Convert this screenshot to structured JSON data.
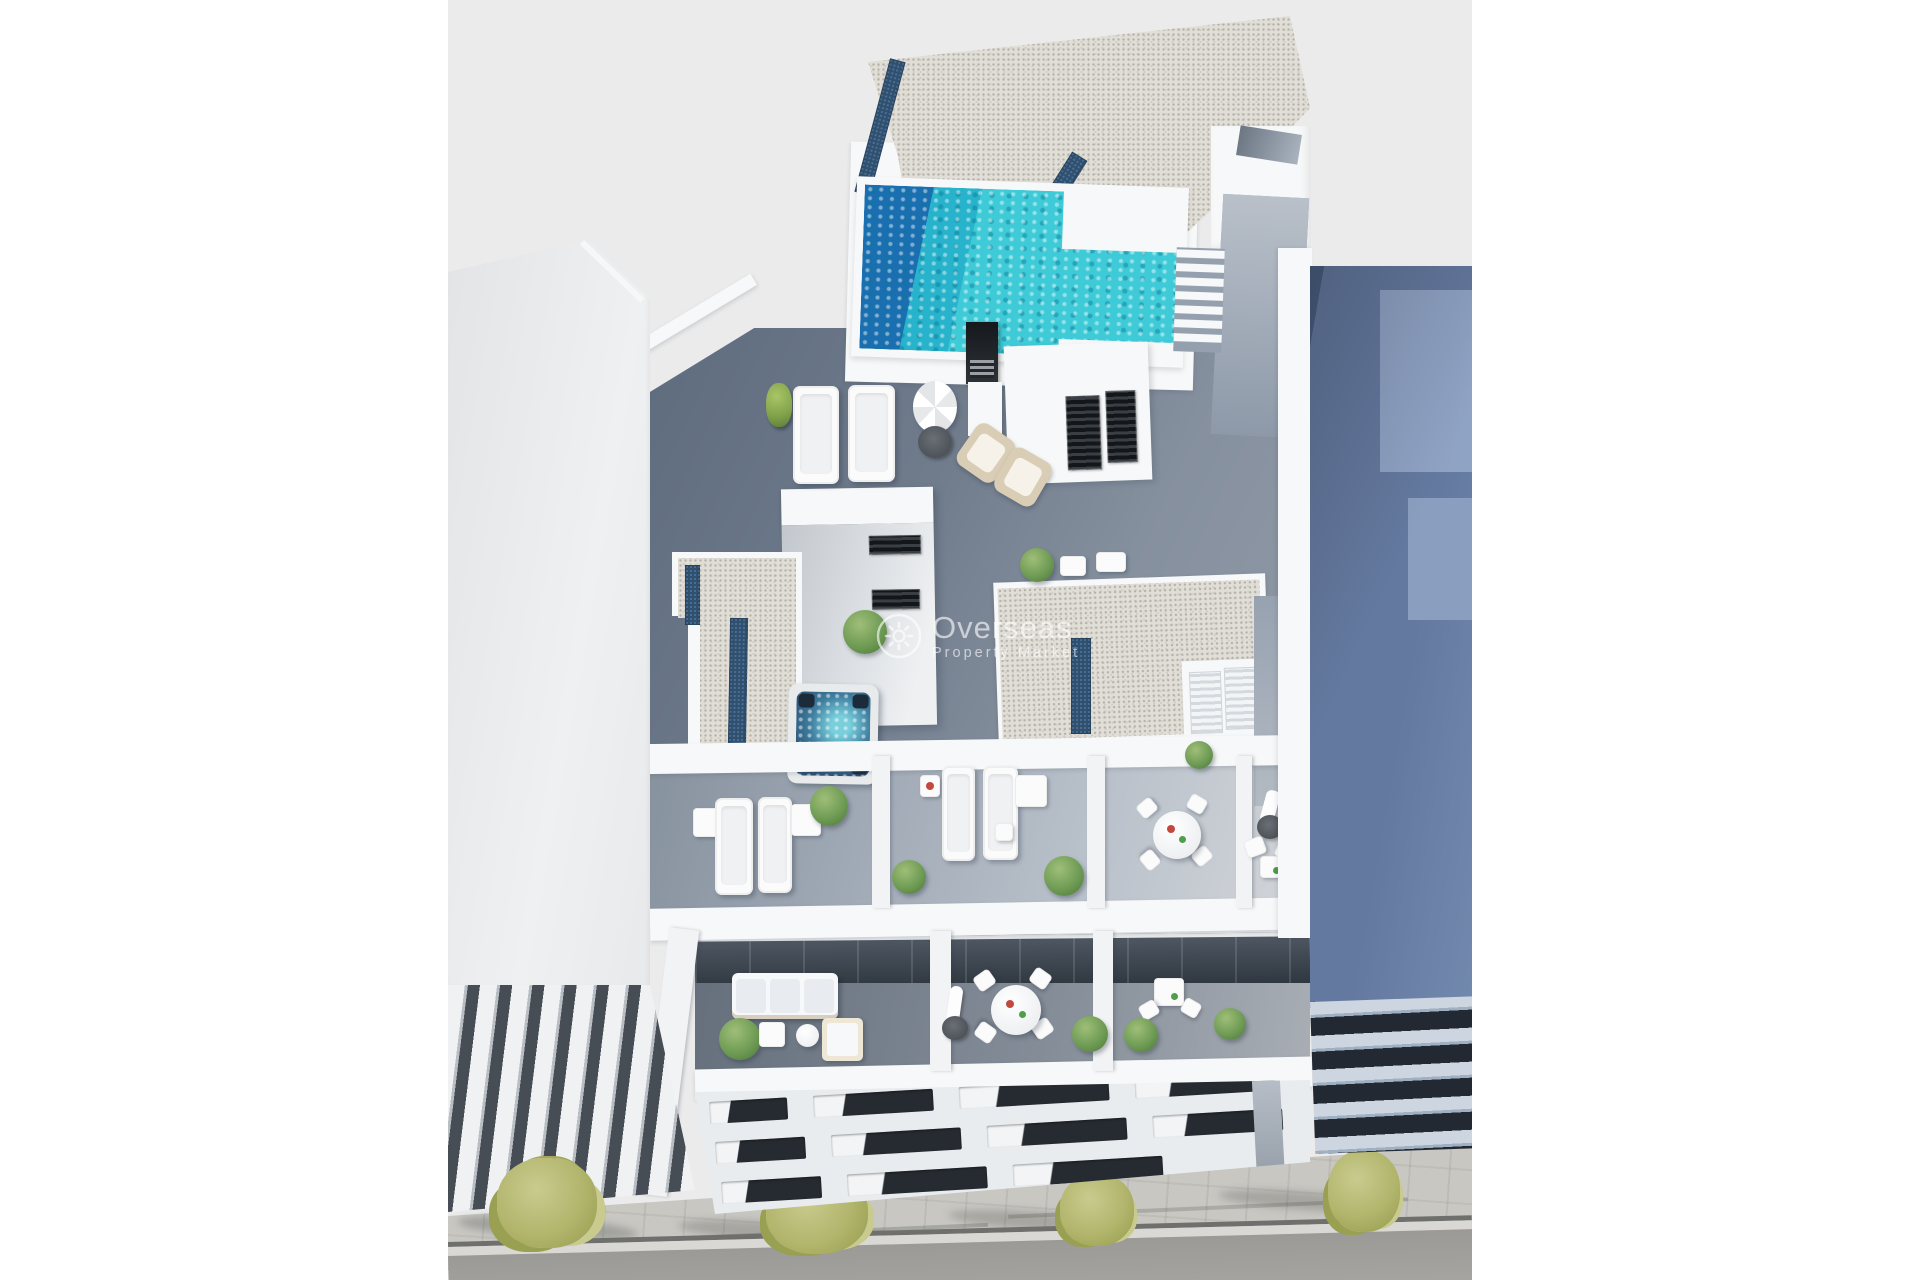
{
  "watermark": {
    "brand": "Overseas",
    "tagline": "Property Market",
    "icon": "sun-logo-icon",
    "color": "rgba(255,255,255,0.62)"
  },
  "scene": {
    "description": "Aerial 3D architectural render of a penthouse rooftop with swimming pool, terraces and street below",
    "elements": [
      "rooftop-pool",
      "jacuzzi",
      "gravel-roof",
      "skylight-strips",
      "sun-loungers",
      "parasols",
      "dining-tables",
      "stairwell-tower",
      "terraces",
      "balconies",
      "louver-facades",
      "neighbor-buildings",
      "sidewalk-trees",
      "street"
    ]
  },
  "colors": {
    "page-bg": "#ffffff",
    "render-bg": "#ebebeb",
    "wall-white": "#f7f8f9",
    "gravel": "#e1ded7",
    "gravel-dot": "#b5b2a9",
    "skylight-navy": "#31506e",
    "skylight-dot": "#49719a",
    "pool-deep": "#1a6fb0",
    "pool-mid": "#27b3cb",
    "pool-bright": "#3ecbd7",
    "deck-shade": "#8c98a9",
    "deck-sun": "#d7dade",
    "deck-dark": "#66707d",
    "glass-dark": "#3a4450",
    "window-dark": "#14171a",
    "slot-dark": "#262b31",
    "louver-dark": "#474d55",
    "right-wall": "#64799f",
    "right-wall-lit": "#92a6c7",
    "right-wall-dark": "#4a5f82",
    "pavement": "#c8c7c2",
    "road": "#a7a6a2",
    "tree-olive": "#b2b56c",
    "tree-light": "#c9cb8e",
    "tree-dark": "#99a052",
    "plant-green": "#6f9c55",
    "plant-dark": "#4f7a3c",
    "jacuzzi-water": "#2b4f72",
    "jacuzzi-foam": "#79cfdc",
    "wicker": "#d9cdb6",
    "furn-white": "#fbfbfc",
    "accent-red": "#c2493d",
    "accent-green": "#4f9e4a",
    "parasol-base": "#4c5157"
  }
}
